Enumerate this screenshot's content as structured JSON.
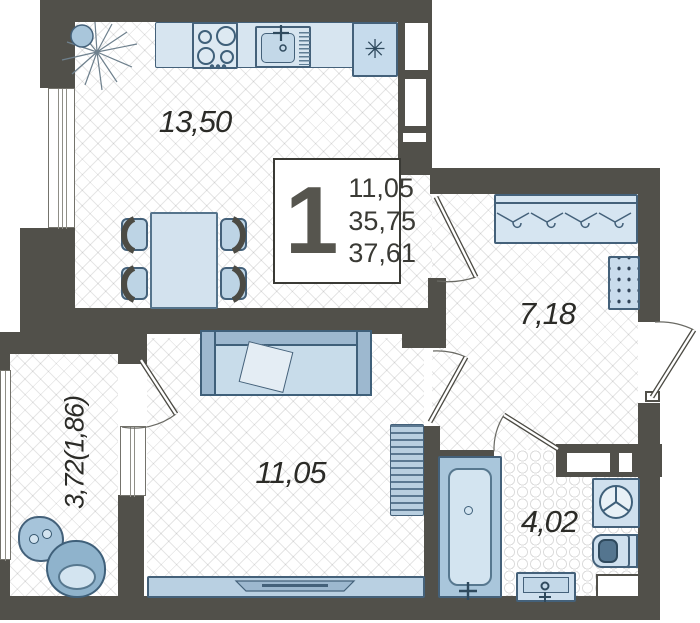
{
  "info_box": {
    "rooms_count": "1",
    "values": [
      "11,05",
      "35,75",
      "37,61"
    ]
  },
  "rooms": {
    "kitchen": {
      "label": "13,50"
    },
    "hallway": {
      "label": "7,18"
    },
    "living": {
      "label": "11,05"
    },
    "bathroom": {
      "label": "4,02"
    },
    "balcony": {
      "label": "3,72(1,86)"
    }
  },
  "icons": {
    "fridge_glyph": "✳"
  },
  "colors": {
    "wall": "#51504a",
    "furniture_fill": "#cfe0ee",
    "furniture_stroke": "#44617a",
    "sofa_back": "#9db8cf",
    "toilet_bowl": "#54758f"
  }
}
